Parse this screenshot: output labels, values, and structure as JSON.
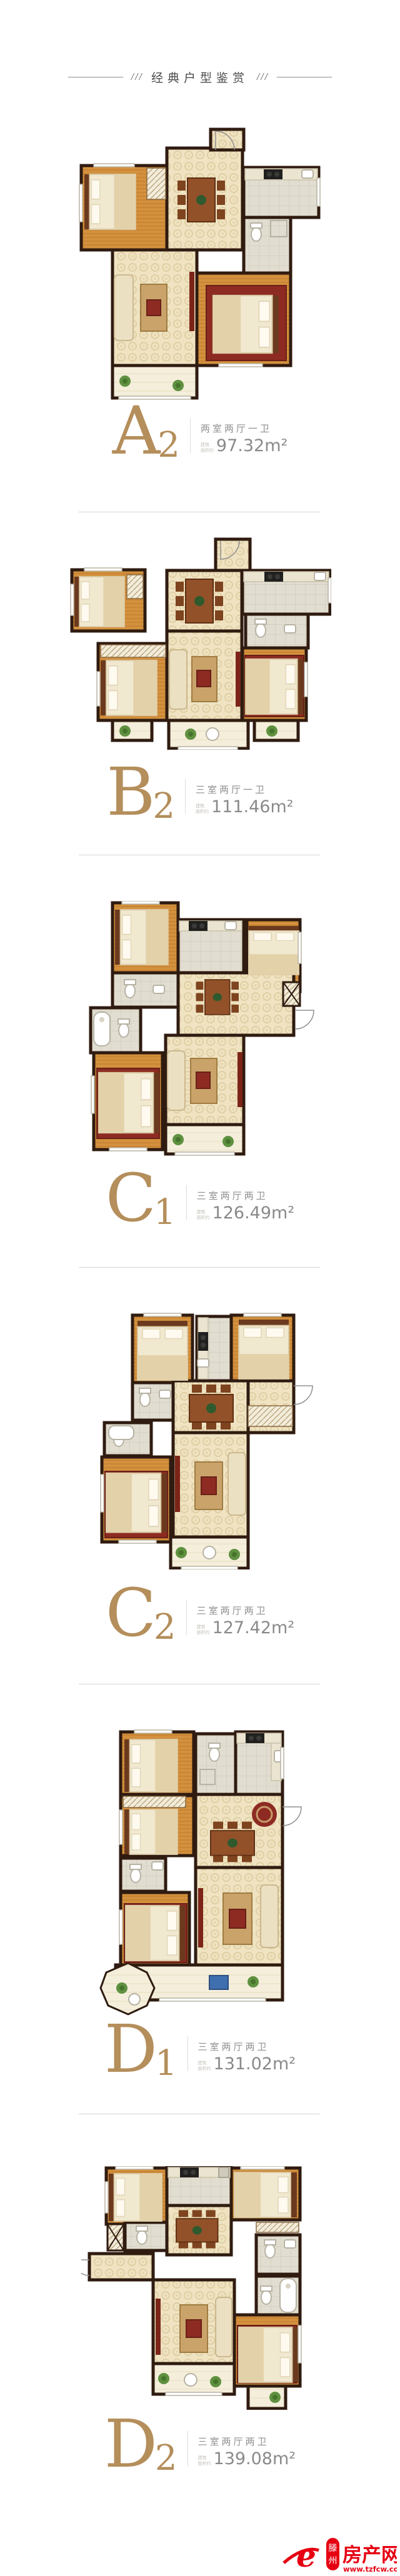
{
  "header": {
    "decor_left": "///",
    "title": "经典户型鉴赏",
    "decor_right": "///"
  },
  "labels": {
    "area_prefix_line1": "建筑",
    "area_prefix_line2": "面积约"
  },
  "plans": [
    {
      "code": "A2",
      "letter": "A",
      "digit": "2",
      "layout": "两室两厅一卫",
      "area": "97.32",
      "unit": "m²"
    },
    {
      "code": "B2",
      "letter": "B",
      "digit": "2",
      "layout": "三室两厅一卫",
      "area": "111.46",
      "unit": "m²"
    },
    {
      "code": "C1",
      "letter": "C",
      "digit": "1",
      "layout": "三室两厅两卫",
      "area": "126.49",
      "unit": "m²"
    },
    {
      "code": "C2",
      "letter": "C",
      "digit": "2",
      "layout": "三室两厅两卫",
      "area": "127.42",
      "unit": "m²"
    },
    {
      "code": "D1",
      "letter": "D",
      "digit": "1",
      "layout": "三室两厅两卫",
      "area": "131.02",
      "unit": "m²"
    },
    {
      "code": "D2",
      "letter": "D",
      "digit": "2",
      "layout": "三室两厅两卫",
      "area": "139.08",
      "unit": "m²"
    }
  ],
  "watermark": {
    "logo_letter": "e",
    "city_char1": "滕",
    "city_char2": "州",
    "site_name": "房产网",
    "url": "www.tzfcw.com.cn",
    "color": "#e60012"
  },
  "colors": {
    "gold": "#b48e5b",
    "wall": "#2f1b10",
    "wood": "#d3913e",
    "hall_tile": "#efe3c2"
  }
}
